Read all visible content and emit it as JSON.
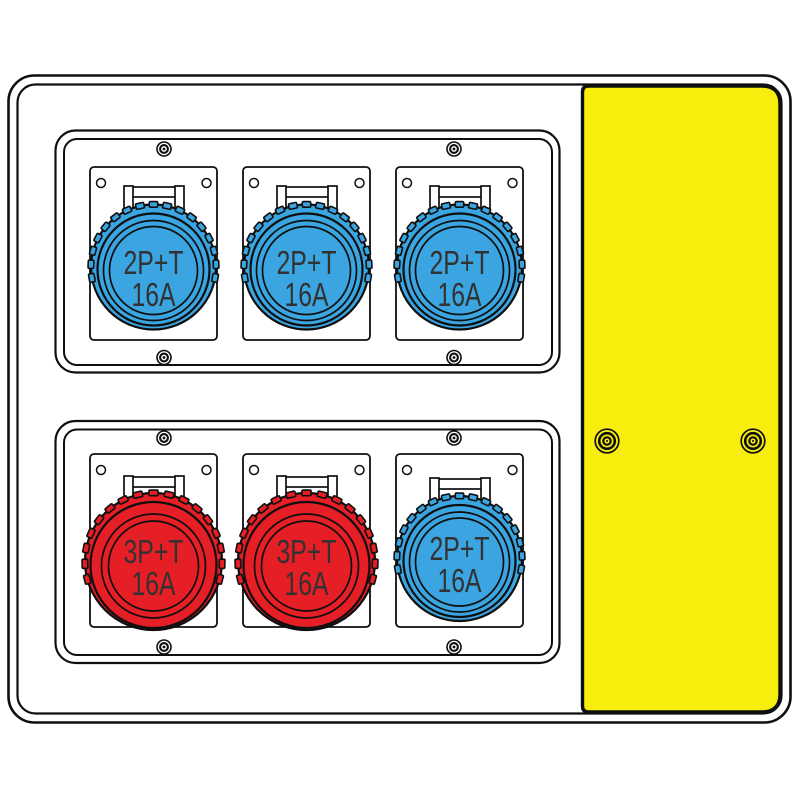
{
  "colors": {
    "outline": "#0f0f0f",
    "enclosure_body": "#ffffff",
    "socket_blue": "#3aa5e0",
    "socket_red": "#e61e25",
    "cover_yellow": "#f8ee0e",
    "label_text": "#323232"
  },
  "side_panel": {
    "color": "#f8ee0e",
    "screw_count": 2
  },
  "socket_groups": [
    {
      "name": "top-group",
      "screw_count": 4,
      "socket_count": 3
    },
    {
      "name": "bottom-group",
      "screw_count": 4,
      "socket_count": 3
    }
  ],
  "sockets": [
    {
      "position": "top-1",
      "type": "blue",
      "color": "#3aa5e0",
      "label_line1": "2P+T",
      "label_line2": "16A"
    },
    {
      "position": "top-2",
      "type": "blue",
      "color": "#3aa5e0",
      "label_line1": "2P+T",
      "label_line2": "16A"
    },
    {
      "position": "top-3",
      "type": "blue",
      "color": "#3aa5e0",
      "label_line1": "2P+T",
      "label_line2": "16A"
    },
    {
      "position": "bottom-1",
      "type": "red",
      "color": "#e61e25",
      "label_line1": "3P+T",
      "label_line2": "16A"
    },
    {
      "position": "bottom-2",
      "type": "red",
      "color": "#e61e25",
      "label_line1": "3P+T",
      "label_line2": "16A"
    },
    {
      "position": "bottom-3",
      "type": "blue",
      "color": "#3aa5e0",
      "label_line1": "2P+T",
      "label_line2": "16A"
    }
  ]
}
